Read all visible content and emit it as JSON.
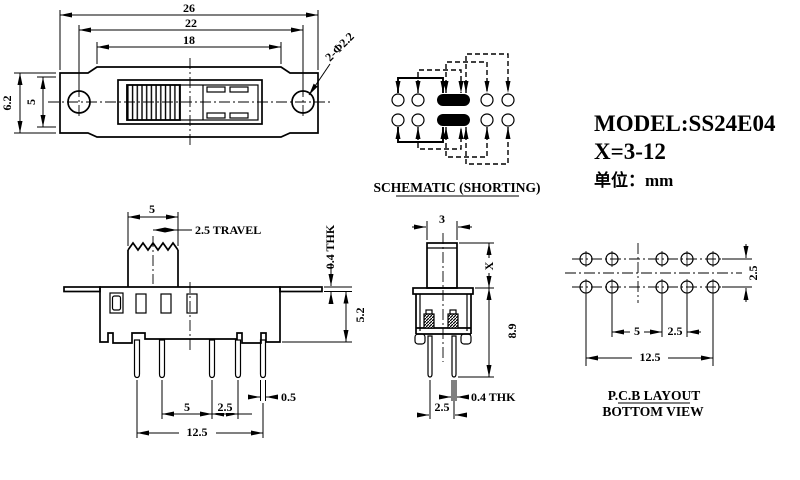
{
  "title_block": {
    "model": "MODEL:SS24E04",
    "x_range": "X=3-12",
    "unit": "单位：mm"
  },
  "schematic": {
    "label": "SCHEMATIC (SHORTING)"
  },
  "pcb": {
    "label_line1": "P.C.B LAYOUT",
    "label_line2": "BOTTOM VIEW",
    "dim_row_pitch": "2.5",
    "dim_pitch_5": "5",
    "dim_pitch_25": "2.5",
    "dim_total": "12.5"
  },
  "top": {
    "dim_total": "26",
    "dim_hole_span": "22",
    "dim_slot": "18",
    "dim_holes": "2-Φ2.2",
    "dim_height": "6.2",
    "dim_inner_height": "5"
  },
  "side": {
    "dim_knob": "5",
    "dim_travel": "2.5 TRAVEL",
    "dim_flange_thk": "0.4 THK",
    "dim_body_h": "5.2",
    "dim_pin_w": "0.5",
    "dim_pitch_5": "5",
    "dim_pitch_25": "2.5",
    "dim_total": "12.5"
  },
  "front": {
    "dim_knob_w": "3",
    "dim_x": "X",
    "dim_body_h": "8.9",
    "dim_pin_thk": "0.4 THK",
    "dim_pitch": "2.5"
  }
}
